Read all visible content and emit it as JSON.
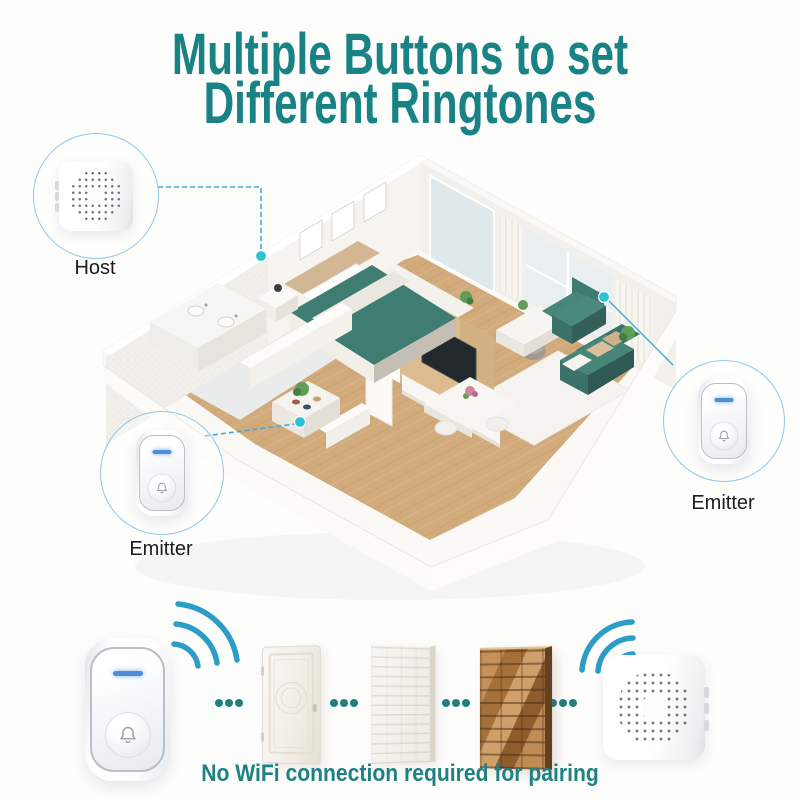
{
  "title": {
    "line1": "Multiple Buttons to set",
    "line2": "Different Ringtones"
  },
  "callouts": {
    "host": {
      "label": "Host"
    },
    "emitter_left": {
      "label": "Emitter"
    },
    "emitter_right": {
      "label": "Emitter"
    }
  },
  "caption": {
    "text": "No WiFi connection required for pairing"
  },
  "floorplan": {
    "marker_count": 3,
    "markers": [
      "bedroom-host-location",
      "entrance-emitter-location",
      "living-room-emitter-location"
    ],
    "marker_color": "#2cc1d4"
  },
  "icons": {
    "doorbell_button": "bell-icon",
    "signal_left": "wifi-waves-icon",
    "signal_right": "wifi-waves-icon",
    "receiver_front": "speaker-grill-icon"
  },
  "colors": {
    "title_teal": "#188285",
    "caption_teal": "#1e8184",
    "connector_blue": "#45a8d8",
    "marker_cyan": "#2cc1d4",
    "wifi_blue": "#2c9dc8",
    "separator_dots_teal": "#1d7f80",
    "led_blue": "#4d8ed8",
    "bed_sofa_teal": "#3f7d72",
    "wood_floor": "#d2ab7c"
  }
}
